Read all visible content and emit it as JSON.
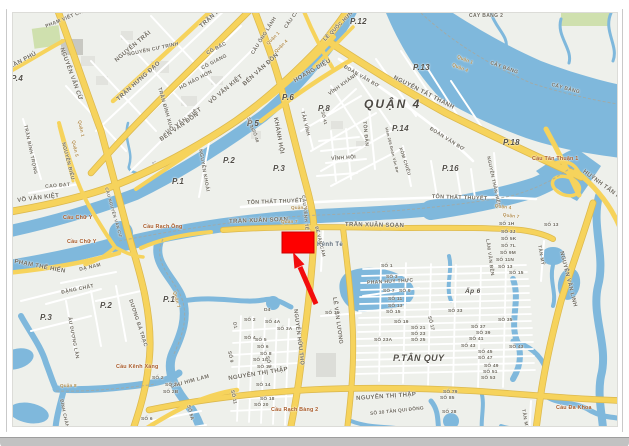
{
  "window": {
    "type": "map-screenshot",
    "frame_color": "#c9c9c9",
    "bottom_bar_color": "#c2c2c2"
  },
  "map": {
    "colors": {
      "land": "#eef0eb",
      "water": "#7fb8dc",
      "road_major": "#f6d35c",
      "road_major_casing": "#dcb94e",
      "road_minor": "#ffffff",
      "park": "#cfe0ae",
      "building": "#e2e3de",
      "marker_red": "#fe0000"
    },
    "marker": {
      "shape": "rectangle-with-arrow",
      "color": "#fe0000",
      "arrow_color": "#f20d0d"
    },
    "labels": [
      {
        "t": "P.4",
        "x": 10,
        "y": 74,
        "c": "ward"
      },
      {
        "t": "P.6",
        "x": 281,
        "y": 93,
        "c": "ward"
      },
      {
        "t": "P.5",
        "x": 246,
        "y": 119,
        "c": "ward"
      },
      {
        "t": "P.2",
        "x": 222,
        "y": 156,
        "c": "ward"
      },
      {
        "t": "P.1",
        "x": 171,
        "y": 177,
        "c": "ward"
      },
      {
        "t": "P.3",
        "x": 272,
        "y": 164,
        "c": "ward"
      },
      {
        "t": "P.8",
        "x": 317,
        "y": 104,
        "c": "ward"
      },
      {
        "t": "P.12",
        "x": 349,
        "y": 17,
        "c": "ward"
      },
      {
        "t": "P.13",
        "x": 412,
        "y": 63,
        "c": "ward"
      },
      {
        "t": "P.14",
        "x": 391,
        "y": 124,
        "c": "ward"
      },
      {
        "t": "P.16",
        "x": 441,
        "y": 164,
        "c": "ward"
      },
      {
        "t": "P.18",
        "x": 502,
        "y": 138,
        "c": "ward"
      },
      {
        "t": "QUẬN 4",
        "x": 363,
        "y": 97,
        "c": "district"
      },
      {
        "t": "P.2",
        "x": 99,
        "y": 301,
        "c": "ward"
      },
      {
        "t": "P.1",
        "x": 162,
        "y": 295,
        "c": "ward"
      },
      {
        "t": "P.3",
        "x": 39,
        "y": 313,
        "c": "ward"
      },
      {
        "t": "P.TÂN QUY",
        "x": 392,
        "y": 353,
        "s": 9,
        "c": "ward"
      },
      {
        "t": "Ấp 6",
        "x": 464,
        "y": 288,
        "s": 6.5,
        "c": "ward"
      },
      {
        "t": "TRẦN PHÚ",
        "x": 4,
        "y": 66,
        "r": -28,
        "c": "road"
      },
      {
        "t": "PHẠM VIẾT CHÁNH",
        "x": 44,
        "y": 24,
        "r": -22,
        "s": 5,
        "c": "road"
      },
      {
        "t": "NGUYỄN VĂN CỪ",
        "x": 63,
        "y": 46,
        "r": 70,
        "c": "road"
      },
      {
        "t": "NGUYỄN TRÃI",
        "x": 113,
        "y": 58,
        "r": -40,
        "c": "road"
      },
      {
        "t": "NGUYỄN CƯ TRINH",
        "x": 126,
        "y": 52,
        "r": -12,
        "s": 5,
        "c": "road"
      },
      {
        "t": "TRẦN HƯNG ĐẠO",
        "x": 115,
        "y": 97,
        "r": -42,
        "c": "road"
      },
      {
        "t": "TRẦN HƯNG ĐẠO",
        "x": 198,
        "y": 24,
        "r": -42,
        "c": "road"
      },
      {
        "t": "CÔ BẮC",
        "x": 205,
        "y": 51,
        "r": -28,
        "s": 5,
        "c": "road"
      },
      {
        "t": "CÔ GIANG",
        "x": 200,
        "y": 66,
        "r": -28,
        "s": 5,
        "c": "road"
      },
      {
        "t": "HỒ HẢO HỚN",
        "x": 178,
        "y": 86,
        "r": -28,
        "s": 5,
        "c": "road"
      },
      {
        "t": "TRẦN ĐÌNH XU",
        "x": 160,
        "y": 86,
        "r": 74,
        "s": 5,
        "c": "road"
      },
      {
        "t": "TRẦN BÌNH TRỌNG",
        "x": 25,
        "y": 124,
        "r": 78,
        "s": 4.8,
        "c": "road"
      },
      {
        "t": "NGUYỄN BIỂU",
        "x": 64,
        "y": 141,
        "r": 76,
        "s": 5,
        "c": "road"
      },
      {
        "t": "CAO ĐẠT",
        "x": 44,
        "y": 184,
        "r": -5,
        "s": 5,
        "c": "road"
      },
      {
        "t": "VÕ VĂN KIỆT",
        "x": 16,
        "y": 197,
        "r": -7,
        "c": "road"
      },
      {
        "t": "VÕ VĂN KIỆT",
        "x": 164,
        "y": 130,
        "r": -35,
        "c": "road"
      },
      {
        "t": "VÕ VĂN KIỆT",
        "x": 207,
        "y": 100,
        "r": -40,
        "c": "road"
      },
      {
        "t": "←",
        "x": 148,
        "y": 160,
        "r": -35,
        "s": 7,
        "c": "road"
      },
      {
        "t": "BẾN VÂN ĐỒN",
        "x": 158,
        "y": 137,
        "r": -35,
        "c": "road"
      },
      {
        "t": "BẾN VÂN ĐỒN",
        "x": 241,
        "y": 82,
        "r": -42,
        "c": "road"
      },
      {
        "t": "NGUYỄN KHOÁI",
        "x": 201,
        "y": 148,
        "r": 80,
        "s": 5,
        "c": "road"
      },
      {
        "t": "CẦU ÔNG LÃNH",
        "x": 250,
        "y": 52,
        "r": -58,
        "s": 5,
        "c": "road"
      },
      {
        "t": "CẦU CALMETTE",
        "x": 283,
        "y": 26,
        "r": -55,
        "s": 5,
        "c": "road"
      },
      {
        "t": "LÊ QUỐC HƯNG",
        "x": 322,
        "y": 38,
        "r": -45,
        "s": 5,
        "c": "road"
      },
      {
        "t": "HOÀNG DIỆU",
        "x": 292,
        "y": 78,
        "r": -30,
        "c": "road"
      },
      {
        "t": "ĐOÀN VĂN BƠ",
        "x": 344,
        "y": 64,
        "r": 30,
        "s": 5,
        "c": "road"
      },
      {
        "t": "ĐOÀN VĂN BƠ",
        "x": 430,
        "y": 126,
        "r": 32,
        "s": 5,
        "c": "road"
      },
      {
        "t": "KHÁNH HỘI",
        "x": 277,
        "y": 116,
        "r": 80,
        "c": "road"
      },
      {
        "t": "TÂN VĨNH",
        "x": 302,
        "y": 110,
        "r": 76,
        "s": 4.8,
        "c": "road"
      },
      {
        "t": "SỐ 41",
        "x": 323,
        "y": 110,
        "r": 76,
        "s": 4.4,
        "c": "num"
      },
      {
        "t": "SỐ 45",
        "x": 249,
        "y": 116,
        "r": 72,
        "s": 4.4,
        "c": "num"
      },
      {
        "t": "SỐ 48",
        "x": 254,
        "y": 128,
        "r": 72,
        "s": 4.4,
        "c": "num"
      },
      {
        "t": "VĨNH KHÁNH",
        "x": 327,
        "y": 92,
        "r": -36,
        "s": 5,
        "c": "road"
      },
      {
        "t": "VĨNH HỘI",
        "x": 330,
        "y": 156,
        "r": -4,
        "s": 5,
        "c": "road"
      },
      {
        "t": "XÓM CHIẾU",
        "x": 401,
        "y": 146,
        "r": 72,
        "s": 4.6,
        "c": "road"
      },
      {
        "t": "Hẻm 266 Đoàn Văn Bơ",
        "x": 387,
        "y": 126,
        "r": 76,
        "s": 4,
        "c": "num"
      },
      {
        "t": "TÔN ĐẢN",
        "x": 365,
        "y": 120,
        "r": 84,
        "s": 5,
        "c": "road"
      },
      {
        "t": "NGUYỄN TẤT THÀNH",
        "x": 394,
        "y": 74,
        "r": 27,
        "c": "road"
      },
      {
        "t": "NGUYỄN THẦN HIẾN",
        "x": 489,
        "y": 155,
        "r": 78,
        "s": 4.6,
        "c": "road"
      },
      {
        "t": "TÔN THẤT THUYẾT",
        "x": 246,
        "y": 200,
        "r": -2,
        "s": 5.4,
        "c": "road"
      },
      {
        "t": "TÔN THẤT THUYẾT",
        "x": 431,
        "y": 194,
        "r": 2,
        "s": 5.4,
        "c": "road"
      },
      {
        "t": "TRẦN XUÂN SOẠN",
        "x": 228,
        "y": 218,
        "r": -2,
        "c": "road"
      },
      {
        "t": "TRẦN XUÂN SOẠN",
        "x": 344,
        "y": 221,
        "r": 1,
        "c": "road"
      },
      {
        "t": "Kênh Tẻ",
        "x": 316,
        "y": 241,
        "s": 6,
        "c": "water-lbl"
      },
      {
        "t": "CẦU KÊNH TẺ",
        "x": 304,
        "y": 194,
        "r": 84,
        "s": 4.6,
        "c": "road"
      },
      {
        "t": "CẦU NGUYỄN VĂN CỪ",
        "x": 107,
        "y": 186,
        "r": 74,
        "s": 4.2,
        "c": "road"
      },
      {
        "t": "HUỲNH TẤN PHÁT",
        "x": 584,
        "y": 168,
        "r": 36,
        "c": "road"
      },
      {
        "t": "NGUYỄN VĂN LINH",
        "x": 562,
        "y": 250,
        "r": 76,
        "s": 5.6,
        "c": "road"
      },
      {
        "t": "NGUYỄN HỮU THỌ",
        "x": 296,
        "y": 308,
        "r": 83,
        "s": 5.6,
        "c": "road"
      },
      {
        "t": "LÊ VĂN LƯƠNG",
        "x": 335,
        "y": 296,
        "r": 82,
        "s": 5.6,
        "c": "road"
      },
      {
        "t": "LÂM VĂN BỀN",
        "x": 487,
        "y": 238,
        "r": 82,
        "s": 4.8,
        "c": "road"
      },
      {
        "t": "TÂN MỸ",
        "x": 539,
        "y": 244,
        "r": 80,
        "s": 4.8,
        "c": "road"
      },
      {
        "t": "TÂN MỸ",
        "x": 523,
        "y": 408,
        "r": 80,
        "s": 4.8,
        "c": "road"
      },
      {
        "t": "BẾ VĂN CẤM",
        "x": 317,
        "y": 225,
        "r": 76,
        "s": 4.4,
        "c": "road"
      },
      {
        "t": "PHAN HUY THỰC",
        "x": 366,
        "y": 280,
        "r": -3,
        "s": 5,
        "c": "road"
      },
      {
        "t": "NGUYỄN THỊ THẬP",
        "x": 227,
        "y": 375,
        "r": -9,
        "c": "road"
      },
      {
        "t": "NGUYỄN THỊ THẬP",
        "x": 355,
        "y": 395,
        "r": -4,
        "c": "road"
      },
      {
        "t": "CẦU HIM LAM",
        "x": 169,
        "y": 384,
        "r": -15,
        "s": 5.4,
        "c": "road"
      },
      {
        "t": "PHẠM THẾ HIỂN",
        "x": 14,
        "y": 258,
        "r": 11,
        "c": "road"
      },
      {
        "t": "DẠ NAM",
        "x": 78,
        "y": 267,
        "r": -13,
        "s": 5,
        "c": "road"
      },
      {
        "t": "ĐẶNG CHẤT",
        "x": 60,
        "y": 290,
        "r": -12,
        "s": 5,
        "c": "road"
      },
      {
        "t": "ÂU DƯƠNG LÂN",
        "x": 69,
        "y": 316,
        "r": 79,
        "s": 4.8,
        "c": "road"
      },
      {
        "t": "DƯƠNG BÁ TRẠC",
        "x": 131,
        "y": 298,
        "r": 72,
        "s": 5.2,
        "c": "road"
      },
      {
        "t": "BÌNH CHÁNH",
        "x": 62,
        "y": 398,
        "r": 78,
        "s": 4.6,
        "c": "road"
      },
      {
        "t": "CÂY BÀNG",
        "x": 490,
        "y": 60,
        "r": 20,
        "s": 5,
        "c": "road"
      },
      {
        "t": "CÂY BÀNG",
        "x": 551,
        "y": 82,
        "r": 15,
        "s": 5,
        "c": "road"
      },
      {
        "t": "CÂY BÀNG 2",
        "x": 468,
        "y": 13,
        "s": 5,
        "c": "road"
      },
      {
        "t": "D4",
        "x": 263,
        "y": 308,
        "c": "num"
      },
      {
        "t": "D1",
        "x": 234,
        "y": 321,
        "r": 78,
        "c": "num"
      },
      {
        "t": "SỐ 2",
        "x": 243,
        "y": 318,
        "c": "num"
      },
      {
        "t": "SỐ 4A",
        "x": 264,
        "y": 320,
        "c": "num"
      },
      {
        "t": "SỐ 3A",
        "x": 276,
        "y": 327,
        "c": "num"
      },
      {
        "t": "SỐ 4",
        "x": 243,
        "y": 336,
        "c": "num"
      },
      {
        "t": "SỐ 5",
        "x": 254,
        "y": 338,
        "c": "num"
      },
      {
        "t": "SỐ 6",
        "x": 256,
        "y": 345,
        "c": "num"
      },
      {
        "t": "SỐ 8",
        "x": 259,
        "y": 352,
        "c": "num"
      },
      {
        "t": "SỐ 10",
        "x": 252,
        "y": 358,
        "c": "num"
      },
      {
        "t": "SỐ 12",
        "x": 256,
        "y": 365,
        "c": "num"
      },
      {
        "t": "SỐ 9",
        "x": 229,
        "y": 350,
        "r": 78,
        "c": "num"
      },
      {
        "t": "SỐ 3",
        "x": 267,
        "y": 355,
        "r": 78,
        "c": "num"
      },
      {
        "t": "SỐ 14",
        "x": 255,
        "y": 383,
        "c": "num"
      },
      {
        "t": "SỐ 18",
        "x": 259,
        "y": 397,
        "c": "num"
      },
      {
        "t": "SỐ 20",
        "x": 253,
        "y": 403,
        "c": "num"
      },
      {
        "t": "SỐ 11",
        "x": 232,
        "y": 389,
        "r": 78,
        "c": "num"
      },
      {
        "t": "SỐ 2",
        "x": 151,
        "y": 376,
        "c": "num"
      },
      {
        "t": "SỐ 2A",
        "x": 164,
        "y": 383,
        "c": "num"
      },
      {
        "t": "SỐ 2B",
        "x": 162,
        "y": 390,
        "c": "num"
      },
      {
        "t": "SỐ 5A",
        "x": 188,
        "y": 404,
        "r": 75,
        "c": "num"
      },
      {
        "t": "SỐ 6",
        "x": 140,
        "y": 417,
        "c": "num"
      },
      {
        "t": "SỐ 1",
        "x": 380,
        "y": 264,
        "c": "num"
      },
      {
        "t": "SỐ 3",
        "x": 385,
        "y": 275,
        "c": "num"
      },
      {
        "t": "SỐ 7",
        "x": 382,
        "y": 289,
        "c": "num"
      },
      {
        "t": "SỐ 9",
        "x": 398,
        "y": 289,
        "c": "num"
      },
      {
        "t": "SỐ 11",
        "x": 387,
        "y": 297,
        "c": "num"
      },
      {
        "t": "SỐ 13",
        "x": 387,
        "y": 304,
        "c": "num"
      },
      {
        "t": "SỐ 15",
        "x": 385,
        "y": 310,
        "c": "num"
      },
      {
        "t": "SỐ 19",
        "x": 393,
        "y": 320,
        "c": "num"
      },
      {
        "t": "SỐ 21",
        "x": 410,
        "y": 326,
        "c": "num"
      },
      {
        "t": "SỐ 23",
        "x": 410,
        "y": 332,
        "c": "num"
      },
      {
        "t": "SỐ 25",
        "x": 410,
        "y": 338,
        "c": "num"
      },
      {
        "t": "SỐ 23A",
        "x": 373,
        "y": 338,
        "c": "num"
      },
      {
        "t": "SỐ 17",
        "x": 429,
        "y": 315,
        "r": 76,
        "c": "num"
      },
      {
        "t": "SỐ 33",
        "x": 447,
        "y": 309,
        "c": "num"
      },
      {
        "t": "SỐ 35",
        "x": 497,
        "y": 318,
        "c": "num"
      },
      {
        "t": "SỐ 37",
        "x": 470,
        "y": 325,
        "c": "num"
      },
      {
        "t": "SỐ 39",
        "x": 475,
        "y": 331,
        "c": "num"
      },
      {
        "t": "SỐ 41",
        "x": 468,
        "y": 337,
        "c": "num"
      },
      {
        "t": "SỐ 43",
        "x": 460,
        "y": 344,
        "c": "num"
      },
      {
        "t": "SỐ 43",
        "x": 508,
        "y": 345,
        "c": "num"
      },
      {
        "t": "SỐ 45",
        "x": 477,
        "y": 350,
        "c": "num"
      },
      {
        "t": "SỐ 47",
        "x": 477,
        "y": 356,
        "c": "num"
      },
      {
        "t": "SỐ 49",
        "x": 483,
        "y": 364,
        "c": "num"
      },
      {
        "t": "SỐ 51",
        "x": 482,
        "y": 370,
        "c": "num"
      },
      {
        "t": "SỐ 53",
        "x": 480,
        "y": 376,
        "c": "num"
      },
      {
        "t": "SỐ 15",
        "x": 324,
        "y": 311,
        "c": "num"
      },
      {
        "t": "SỐ 1H",
        "x": 498,
        "y": 222,
        "c": "num"
      },
      {
        "t": "SỐ 3J",
        "x": 500,
        "y": 230,
        "c": "num"
      },
      {
        "t": "SỐ 5K",
        "x": 500,
        "y": 237,
        "c": "num"
      },
      {
        "t": "SỐ 7L",
        "x": 500,
        "y": 244,
        "c": "num"
      },
      {
        "t": "SỐ 9M",
        "x": 499,
        "y": 251,
        "c": "num"
      },
      {
        "t": "SỐ 11N",
        "x": 495,
        "y": 258,
        "c": "num"
      },
      {
        "t": "SỐ 13",
        "x": 497,
        "y": 265,
        "c": "num"
      },
      {
        "t": "SỐ 15",
        "x": 508,
        "y": 271,
        "c": "num"
      },
      {
        "t": "SỐ 13",
        "x": 543,
        "y": 223,
        "c": "num"
      },
      {
        "t": "SỐ 79",
        "x": 442,
        "y": 390,
        "c": "num"
      },
      {
        "t": "SỐ 85",
        "x": 439,
        "y": 396,
        "c": "num"
      },
      {
        "t": "SỐ 28",
        "x": 441,
        "y": 410,
        "c": "num"
      },
      {
        "t": "SỐ 30 TÂN QUI ĐÔNG",
        "x": 369,
        "y": 412,
        "r": -6,
        "c": "num"
      },
      {
        "t": "Cầu Chữ Y",
        "x": 62,
        "y": 215,
        "c": "bridge"
      },
      {
        "t": "Cầu Chữ Y",
        "x": 66,
        "y": 239,
        "c": "bridge"
      },
      {
        "t": "Cầu Rạch Ông",
        "x": 142,
        "y": 224,
        "c": "bridge"
      },
      {
        "t": "Cầu Kênh Xáng",
        "x": 115,
        "y": 364,
        "c": "bridge"
      },
      {
        "t": "Cầu Rạch Bàng 2",
        "x": 270,
        "y": 407,
        "c": "bridge"
      },
      {
        "t": "Cầu Tân Thuận 1",
        "x": 531,
        "y": 156,
        "c": "bridge"
      },
      {
        "t": "Cầu Đa Khoa",
        "x": 555,
        "y": 405,
        "c": "bridge"
      },
      {
        "t": "Quận 1",
        "x": 265,
        "y": 42,
        "r": -45,
        "c": "bound"
      },
      {
        "t": "Quận 4",
        "x": 273,
        "y": 50,
        "r": -45,
        "c": "bound"
      },
      {
        "t": "Quận 1",
        "x": 457,
        "y": 54,
        "r": 22,
        "c": "bound"
      },
      {
        "t": "Quận 4",
        "x": 452,
        "y": 62,
        "r": 22,
        "c": "bound"
      },
      {
        "t": "Quận 4",
        "x": 290,
        "y": 205,
        "c": "bound"
      },
      {
        "t": "Quận 7",
        "x": 280,
        "y": 219,
        "c": "bound"
      },
      {
        "t": "Quận 4",
        "x": 494,
        "y": 203,
        "r": 8,
        "c": "bound"
      },
      {
        "t": "Quận 7",
        "x": 502,
        "y": 212,
        "r": 8,
        "c": "bound"
      },
      {
        "t": "Quận 1",
        "x": 80,
        "y": 119,
        "r": 78,
        "c": "bound"
      },
      {
        "t": "Quận 5",
        "x": 74,
        "y": 139,
        "r": 78,
        "c": "bound"
      },
      {
        "t": "Quận 8",
        "x": 59,
        "y": 383,
        "c": "bound"
      },
      {
        "t": "Quận 7",
        "x": 175,
        "y": 290,
        "r": 75,
        "c": "bound"
      }
    ]
  }
}
